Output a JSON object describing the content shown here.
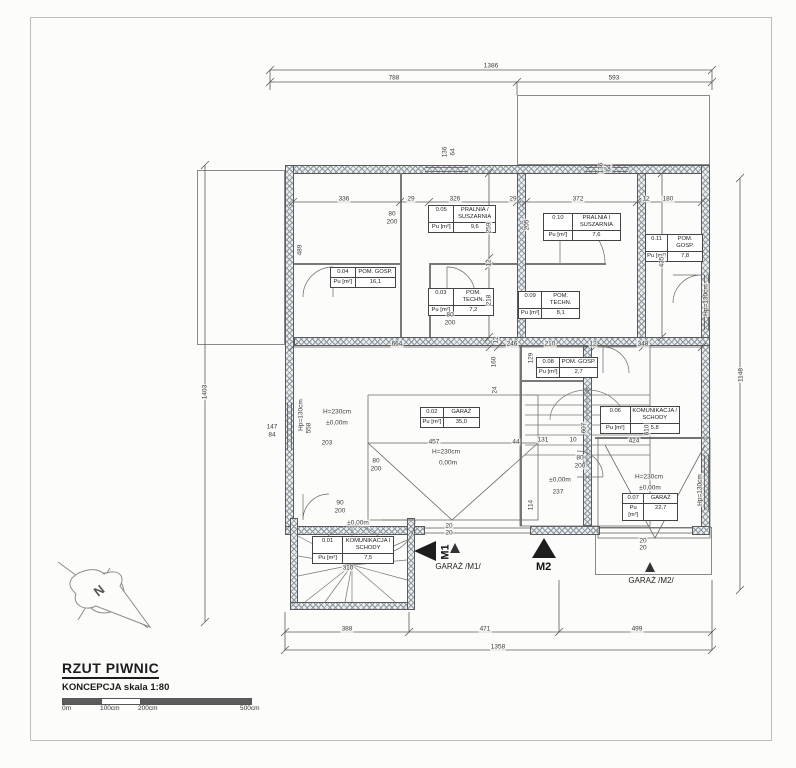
{
  "page": {
    "title": "RZUT PIWNIC",
    "subtitle": "KONCEPCJA skala 1:80",
    "north_label": "N",
    "scale_bar": {
      "labels": [
        "0m",
        "100cm",
        "200cm",
        "500cm"
      ]
    }
  },
  "labels": {
    "pu": "Pu [m²]"
  },
  "rooms": [
    {
      "number": "0.01",
      "name": "KOMUNIKACJA I SCHODY",
      "area": "7,5"
    },
    {
      "number": "0.02",
      "name": "GARAŻ",
      "area": "35,0"
    },
    {
      "number": "0.03",
      "name": "POM. TECHN.",
      "area": "7,2"
    },
    {
      "number": "0.04",
      "name": "POM. GOSP.",
      "area": "16,1"
    },
    {
      "number": "0.05",
      "name": "PRALNIA / SUSZARNIA",
      "area": "9,6"
    },
    {
      "number": "0.06",
      "name": "KOMUNIKACJA / SCHODY",
      "area": "5,8"
    },
    {
      "number": "0.07",
      "name": "GARAŻ",
      "area": "22,7"
    },
    {
      "number": "0.08",
      "name": "POM. GOSP.",
      "area": "2,7"
    },
    {
      "number": "0.09",
      "name": "POM. TECHN.",
      "area": "8,1"
    },
    {
      "number": "0.10",
      "name": "PRALNIA I SUSZARNIA",
      "area": "7,6"
    },
    {
      "number": "0.11",
      "name": "POM. GOSP.",
      "area": "7,8"
    }
  ],
  "markers": {
    "m1": "M1",
    "m1_caption": "GARAŻ /M1/",
    "m2": "M2",
    "m2_caption": "GARAŻ /M2/"
  },
  "dims": [
    {
      "t": "1386",
      "x": 491,
      "y": 66
    },
    {
      "t": "788",
      "x": 394,
      "y": 78
    },
    {
      "t": "593",
      "x": 614,
      "y": 78
    },
    {
      "t": "336",
      "x": 344,
      "y": 199
    },
    {
      "t": "29",
      "x": 411,
      "y": 199
    },
    {
      "t": "326",
      "x": 455,
      "y": 199
    },
    {
      "t": "29",
      "x": 513,
      "y": 199
    },
    {
      "t": "372",
      "x": 578,
      "y": 199
    },
    {
      "t": "12",
      "x": 646,
      "y": 199
    },
    {
      "t": "180",
      "x": 668,
      "y": 199
    },
    {
      "t": "489",
      "x": 300,
      "y": 250,
      "r": -90
    },
    {
      "t": "259",
      "x": 489,
      "y": 228,
      "r": -90
    },
    {
      "t": "12",
      "x": 489,
      "y": 263,
      "r": -90
    },
    {
      "t": "218",
      "x": 489,
      "y": 300,
      "r": -90
    },
    {
      "t": "205",
      "x": 527,
      "y": 225,
      "r": -90
    },
    {
      "t": "435",
      "x": 662,
      "y": 262,
      "r": -90
    },
    {
      "t": "664",
      "x": 397,
      "y": 344
    },
    {
      "t": "12",
      "x": 496,
      "y": 340,
      "r": -90
    },
    {
      "t": "246",
      "x": 512,
      "y": 344
    },
    {
      "t": "210",
      "x": 550,
      "y": 344
    },
    {
      "t": "12",
      "x": 593,
      "y": 344
    },
    {
      "t": "348",
      "x": 643,
      "y": 344
    },
    {
      "t": "160",
      "x": 494,
      "y": 362,
      "r": -90
    },
    {
      "t": "24",
      "x": 495,
      "y": 390,
      "r": -90
    },
    {
      "t": "129",
      "x": 531,
      "y": 358,
      "r": -90
    },
    {
      "t": "607",
      "x": 584,
      "y": 428,
      "r": -90
    },
    {
      "t": "610",
      "x": 647,
      "y": 430,
      "r": -90
    },
    {
      "t": "558",
      "x": 309,
      "y": 428,
      "r": -90
    },
    {
      "t": "203",
      "x": 327,
      "y": 443
    },
    {
      "t": "457",
      "x": 434,
      "y": 442
    },
    {
      "t": "44",
      "x": 516,
      "y": 442
    },
    {
      "t": "131",
      "x": 543,
      "y": 440
    },
    {
      "t": "10",
      "x": 573,
      "y": 440
    },
    {
      "t": "424",
      "x": 634,
      "y": 441
    },
    {
      "t": "114",
      "x": 531,
      "y": 505,
      "r": -90
    },
    {
      "t": "237",
      "x": 558,
      "y": 492
    },
    {
      "t": "310",
      "x": 348,
      "y": 568
    },
    {
      "t": "388",
      "x": 347,
      "y": 629
    },
    {
      "t": "471",
      "x": 485,
      "y": 629
    },
    {
      "t": "499",
      "x": 637,
      "y": 629
    },
    {
      "t": "1358",
      "x": 498,
      "y": 647
    },
    {
      "t": "1403",
      "x": 205,
      "y": 392,
      "r": -90
    },
    {
      "t": "1148",
      "x": 741,
      "y": 375,
      "r": -90
    },
    {
      "t": "147",
      "x": 272,
      "y": 427
    },
    {
      "t": "84",
      "x": 272,
      "y": 435
    },
    {
      "t": "136",
      "x": 445,
      "y": 152,
      "r": -90
    },
    {
      "t": "64",
      "x": 453,
      "y": 152,
      "r": -90
    },
    {
      "t": "136",
      "x": 601,
      "y": 168,
      "r": -90
    },
    {
      "t": "64",
      "x": 609,
      "y": 168,
      "r": -90
    },
    {
      "t": "80",
      "x": 392,
      "y": 214
    },
    {
      "t": "200",
      "x": 392,
      "y": 222
    },
    {
      "t": "80",
      "x": 450,
      "y": 315
    },
    {
      "t": "200",
      "x": 450,
      "y": 323
    },
    {
      "t": "80",
      "x": 376,
      "y": 461
    },
    {
      "t": "200",
      "x": 376,
      "y": 469
    },
    {
      "t": "80",
      "x": 580,
      "y": 458
    },
    {
      "t": "200",
      "x": 580,
      "y": 466
    },
    {
      "t": "90",
      "x": 340,
      "y": 503
    },
    {
      "t": "200",
      "x": 340,
      "y": 511
    },
    {
      "t": "20",
      "x": 449,
      "y": 526
    },
    {
      "t": "20",
      "x": 449,
      "y": 533
    },
    {
      "t": "20",
      "x": 643,
      "y": 541
    },
    {
      "t": "20",
      "x": 643,
      "y": 548
    },
    {
      "n": "annotation-label",
      "t": "H=230cm",
      "x": 337,
      "y": 412
    },
    {
      "n": "annotation-label",
      "t": "±0,00m",
      "x": 337,
      "y": 423
    },
    {
      "n": "annotation-label",
      "t": "H=230cm",
      "x": 446,
      "y": 452
    },
    {
      "n": "annotation-label",
      "t": "0,00m",
      "x": 448,
      "y": 463
    },
    {
      "n": "annotation-label",
      "t": "H=230cm",
      "x": 649,
      "y": 477
    },
    {
      "n": "annotation-label",
      "t": "±0,00m",
      "x": 650,
      "y": 488
    },
    {
      "n": "annotation-label",
      "t": "±0,00m",
      "x": 358,
      "y": 523
    },
    {
      "n": "annotation-label",
      "t": "±0,00m",
      "x": 560,
      "y": 480
    },
    {
      "n": "annotation-label",
      "t": "Hp=130cm",
      "x": 301,
      "y": 415,
      "r": -90
    },
    {
      "n": "annotation-label",
      "t": "Hp=130cm",
      "x": 700,
      "y": 490,
      "r": -90
    },
    {
      "n": "annotation-label",
      "t": "Hp=130cm",
      "x": 706,
      "y": 300,
      "r": -90
    }
  ]
}
